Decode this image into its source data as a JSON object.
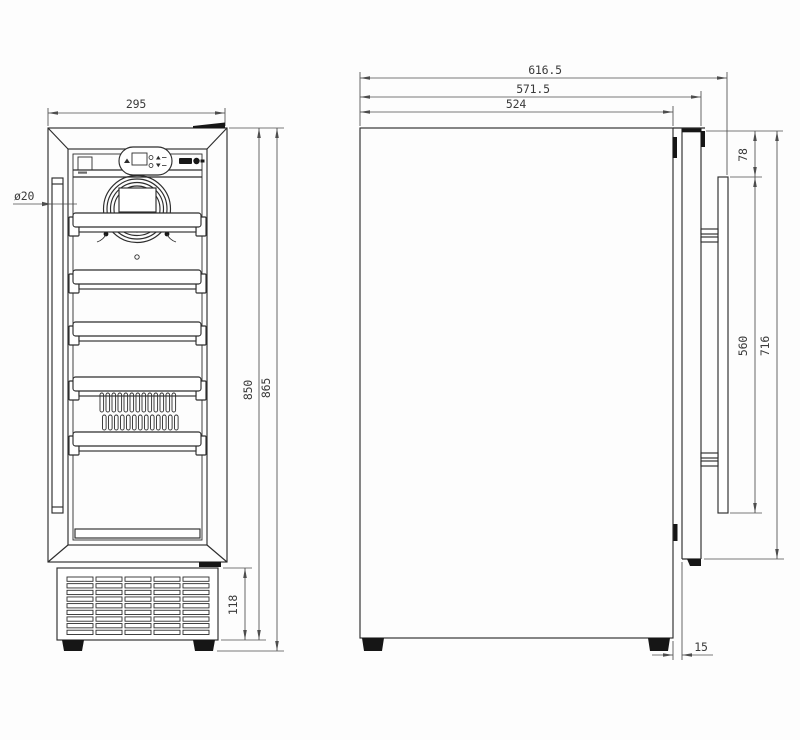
{
  "colors": {
    "background": "#fdfdfd",
    "object_line": "#2d2d2d",
    "dimension_line": "#4d4d4d",
    "dimension_text": "#3a3a3a",
    "filled_marks": "#161616"
  },
  "front_view": {
    "dimensions": {
      "width": "295",
      "handle_diameter": "ø20",
      "base_height": "118",
      "height_without_feet": "850",
      "overall_height": "865"
    },
    "shelves": 5,
    "wine_rack": {
      "rows": 2,
      "slots_per_row": 13
    },
    "vent_grille": {
      "columns": 5,
      "rows": 9
    }
  },
  "side_view": {
    "dimensions": {
      "overall_depth": "616.5",
      "depth_to_door_front": "571.5",
      "cabinet_depth": "524",
      "handle_top_offset": "78",
      "handle_length": "560",
      "door_height": "716",
      "door_clearance": "15"
    }
  }
}
